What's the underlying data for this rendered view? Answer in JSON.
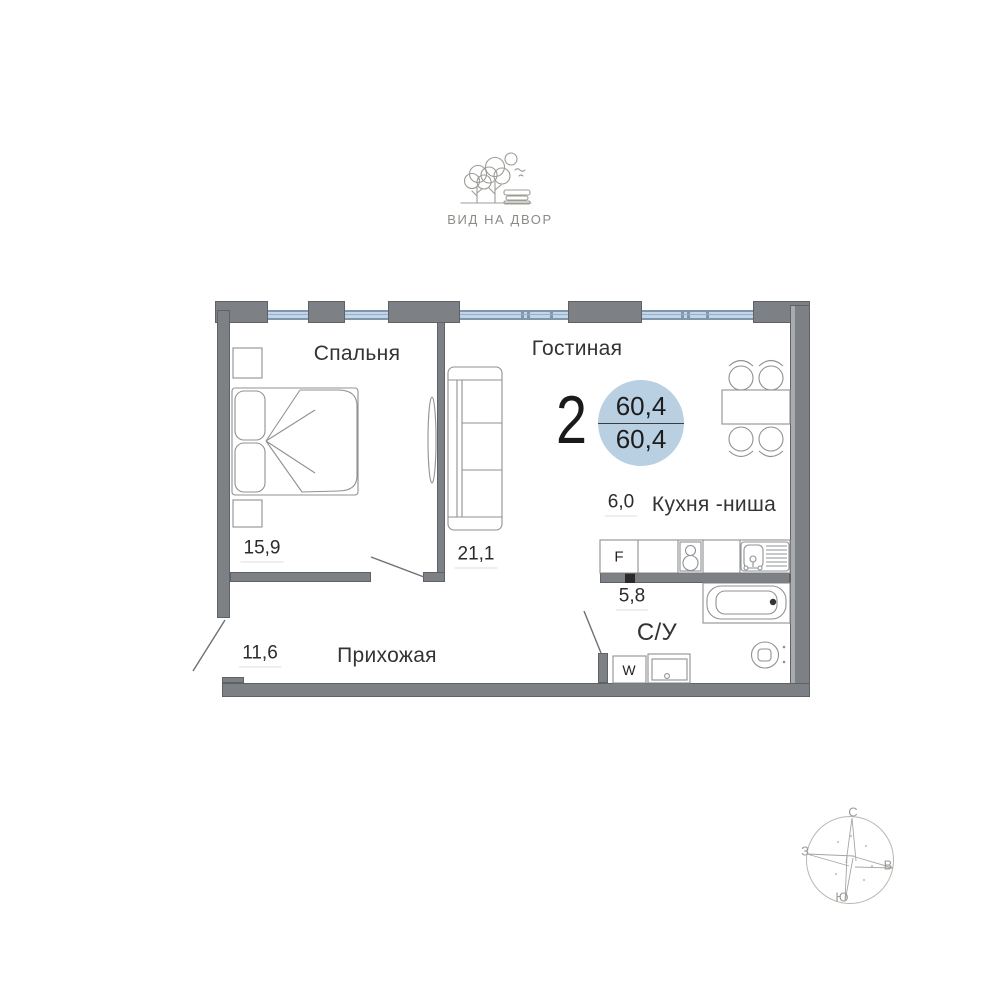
{
  "header": {
    "view_label": "ВИД НА ДВОР"
  },
  "plan": {
    "badge": {
      "rooms_count": "2",
      "total_area": "60,4",
      "living_area": "60,4"
    },
    "rooms": [
      {
        "name": "Спальня",
        "area": "15,9"
      },
      {
        "name": "Гостиная",
        "area": "21,1"
      },
      {
        "name": "Кухня -ниша",
        "area": "6,0"
      },
      {
        "name": "Прихожая",
        "area": "11,6"
      },
      {
        "name": "С/У",
        "area": "5,8"
      }
    ],
    "appliances": {
      "fridge_label": "F",
      "washer_label": "W"
    }
  },
  "compass": {
    "north": "С",
    "east": "В",
    "south": "Ю",
    "west": "З"
  },
  "colors": {
    "wall": "#7d8084",
    "window_glass": "#c1d6e8",
    "badge_fill": "#b9cfe2"
  }
}
